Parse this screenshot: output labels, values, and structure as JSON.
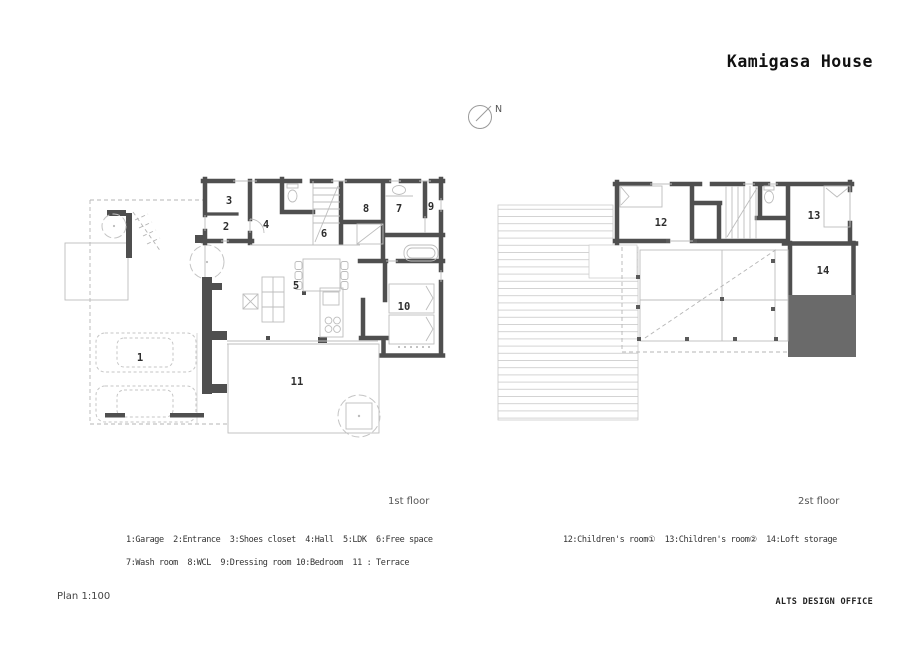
{
  "title": "Kamigasa House",
  "compass": {
    "label": "N"
  },
  "floor1": {
    "caption": "1st floor"
  },
  "floor2": {
    "caption": "2st floor"
  },
  "rooms": {
    "r1": "1",
    "r2": "2",
    "r3": "3",
    "r4": "4",
    "r5": "5",
    "r6": "6",
    "r7": "7",
    "r8": "8",
    "r9": "9",
    "r10": "10",
    "r11": "11",
    "r12": "12",
    "r13": "13",
    "r14": "14"
  },
  "legend1": {
    "line1": "1:Garage  2:Entrance  3:Shoes closet  4:Hall  5:LDK  6:Free space",
    "line2": "7:Wash room  8:WCL  9:Dressing room 10:Bedroom  11 : Terrace"
  },
  "legend2": {
    "line1": "12:Children's room①  13:Children's room②  14:Loft storage"
  },
  "footer": {
    "scale": "Plan 1:100",
    "office": "ALTS DESIGN OFFICE"
  }
}
